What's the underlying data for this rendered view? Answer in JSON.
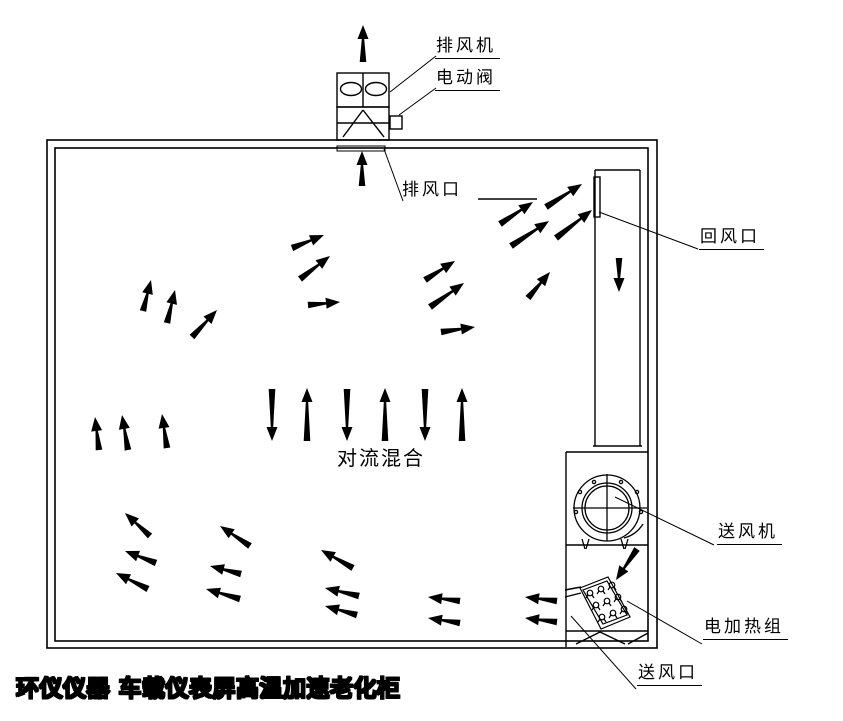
{
  "diagram": {
    "background": "#ffffff",
    "line_color": "#000000",
    "brand": {
      "text": "环仪仪器 车载仪表屏高温加速老化柜",
      "fill_color": "#f5dd00",
      "outline_color": "#000000"
    },
    "labels": [
      {
        "id": "exhaust-fan",
        "text": "排风机",
        "x": 435,
        "y": 37,
        "underline": true,
        "leader": [
          390,
          92,
          436,
          56
        ]
      },
      {
        "id": "electric-valve",
        "text": "电动阀",
        "x": 435,
        "y": 69,
        "underline": true,
        "leader": [
          399,
          115,
          436,
          88
        ]
      },
      {
        "id": "exhaust-outlet",
        "text": "排风口",
        "x": 402,
        "y": 181,
        "underline": false,
        "leader": [
          384,
          149,
          403,
          201
        ]
      },
      {
        "id": "return-inlet",
        "text": "回风口",
        "x": 699,
        "y": 228,
        "underline": true,
        "leader": [
          599,
          212,
          698,
          249
        ]
      },
      {
        "id": "supply-fan",
        "text": "送风机",
        "x": 717,
        "y": 523,
        "underline": true,
        "leader": [
          615,
          497,
          714,
          545
        ]
      },
      {
        "id": "heater-group",
        "text": "电加热组",
        "x": 703,
        "y": 618,
        "underline": true,
        "leader": [
          627,
          601,
          702,
          644
        ]
      },
      {
        "id": "supply-outlet",
        "text": "送风口",
        "x": 637,
        "y": 664,
        "underline": true,
        "leader": [
          571,
          616,
          636,
          689
        ]
      },
      {
        "id": "convection-mixing",
        "text": "对流混合",
        "x": 337,
        "y": 447,
        "underline": false,
        "leader": null
      }
    ],
    "extra_lines": [
      [
        478,
        199,
        537,
        199
      ]
    ],
    "heater_coils": [
      [
        590,
        593
      ],
      [
        601,
        589
      ],
      [
        612,
        585
      ],
      [
        596,
        605
      ],
      [
        607,
        601
      ],
      [
        618,
        597
      ],
      [
        602,
        617
      ],
      [
        613,
        613
      ],
      [
        624,
        609
      ]
    ],
    "arrows": [
      {
        "name": "exhaust-out-top",
        "from": [
          363,
          62
        ],
        "to": [
          363,
          25
        ]
      },
      {
        "name": "to-exhaust-opening",
        "from": [
          362,
          186
        ],
        "to": [
          362,
          151
        ]
      },
      {
        "name": "duct-down",
        "from": [
          619,
          258
        ],
        "to": [
          619,
          292
        ]
      },
      {
        "name": "fan-discharge",
        "from": [
          637,
          549
        ],
        "to": [
          616,
          580
        ]
      },
      {
        "name": "to-return-1",
        "from": [
          500,
          224
        ],
        "to": [
          533,
          202
        ]
      },
      {
        "name": "to-return-2",
        "from": [
          546,
          207
        ],
        "to": [
          582,
          184
        ]
      },
      {
        "name": "to-return-3",
        "from": [
          511,
          246
        ],
        "to": [
          549,
          221
        ]
      },
      {
        "name": "to-return-4",
        "from": [
          556,
          238
        ],
        "to": [
          592,
          210
        ]
      },
      {
        "name": "to-return-5",
        "from": [
          528,
          298
        ],
        "to": [
          550,
          272
        ]
      },
      {
        "name": "mid-left-1",
        "from": [
          292,
          248
        ],
        "to": [
          324,
          235
        ]
      },
      {
        "name": "mid-left-2",
        "from": [
          300,
          279
        ],
        "to": [
          330,
          256
        ]
      },
      {
        "name": "mid-left-3",
        "from": [
          308,
          305
        ],
        "to": [
          340,
          302
        ]
      },
      {
        "name": "mid-right-1",
        "from": [
          425,
          280
        ],
        "to": [
          455,
          261
        ]
      },
      {
        "name": "mid-right-2",
        "from": [
          430,
          307
        ],
        "to": [
          464,
          283
        ]
      },
      {
        "name": "mid-right-3",
        "from": [
          441,
          332
        ],
        "to": [
          475,
          327
        ]
      },
      {
        "name": "upper-left-1",
        "from": [
          143,
          311
        ],
        "to": [
          151,
          280
        ]
      },
      {
        "name": "upper-left-2",
        "from": [
          167,
          323
        ],
        "to": [
          175,
          290
        ]
      },
      {
        "name": "upper-left-3",
        "from": [
          192,
          337
        ],
        "to": [
          217,
          310
        ]
      },
      {
        "name": "left-up-1",
        "from": [
          99,
          450
        ],
        "to": [
          95,
          417
        ]
      },
      {
        "name": "left-up-2",
        "from": [
          128,
          450
        ],
        "to": [
          122,
          415
        ]
      },
      {
        "name": "left-up-3",
        "from": [
          167,
          448
        ],
        "to": [
          162,
          414
        ]
      },
      {
        "name": "convection-down-1",
        "from": [
          272,
          389
        ],
        "to": [
          272,
          441
        ]
      },
      {
        "name": "convection-up-1",
        "from": [
          307,
          441
        ],
        "to": [
          307,
          388
        ]
      },
      {
        "name": "convection-down-2",
        "from": [
          347,
          389
        ],
        "to": [
          347,
          441
        ]
      },
      {
        "name": "convection-up-2",
        "from": [
          385,
          441
        ],
        "to": [
          385,
          388
        ]
      },
      {
        "name": "convection-down-3",
        "from": [
          425,
          389
        ],
        "to": [
          425,
          441
        ]
      },
      {
        "name": "convection-up-3",
        "from": [
          462,
          441
        ],
        "to": [
          462,
          388
        ]
      },
      {
        "name": "bottom-left-1",
        "from": [
          150,
          536
        ],
        "to": [
          125,
          513
        ]
      },
      {
        "name": "bottom-left-2",
        "from": [
          156,
          563
        ],
        "to": [
          125,
          551
        ]
      },
      {
        "name": "bottom-left-3",
        "from": [
          148,
          589
        ],
        "to": [
          116,
          573
        ]
      },
      {
        "name": "bottom-left-4",
        "from": [
          250,
          546
        ],
        "to": [
          220,
          526
        ]
      },
      {
        "name": "bottom-left-5",
        "from": [
          241,
          574
        ],
        "to": [
          210,
          566
        ]
      },
      {
        "name": "bottom-left-6",
        "from": [
          240,
          599
        ],
        "to": [
          206,
          589
        ]
      },
      {
        "name": "bottom-mid-1",
        "from": [
          353,
          568
        ],
        "to": [
          321,
          550
        ]
      },
      {
        "name": "bottom-mid-2",
        "from": [
          359,
          596
        ],
        "to": [
          325,
          588
        ]
      },
      {
        "name": "bottom-mid-3",
        "from": [
          357,
          615
        ],
        "to": [
          325,
          606
        ]
      },
      {
        "name": "bottom-mid-4",
        "from": [
          460,
          601
        ],
        "to": [
          428,
          597
        ]
      },
      {
        "name": "bottom-mid-5",
        "from": [
          460,
          623
        ],
        "to": [
          428,
          618
        ]
      },
      {
        "name": "supply-out-1",
        "from": [
          557,
          601
        ],
        "to": [
          525,
          597
        ]
      },
      {
        "name": "supply-out-2",
        "from": [
          557,
          622
        ],
        "to": [
          525,
          618
        ]
      }
    ]
  }
}
